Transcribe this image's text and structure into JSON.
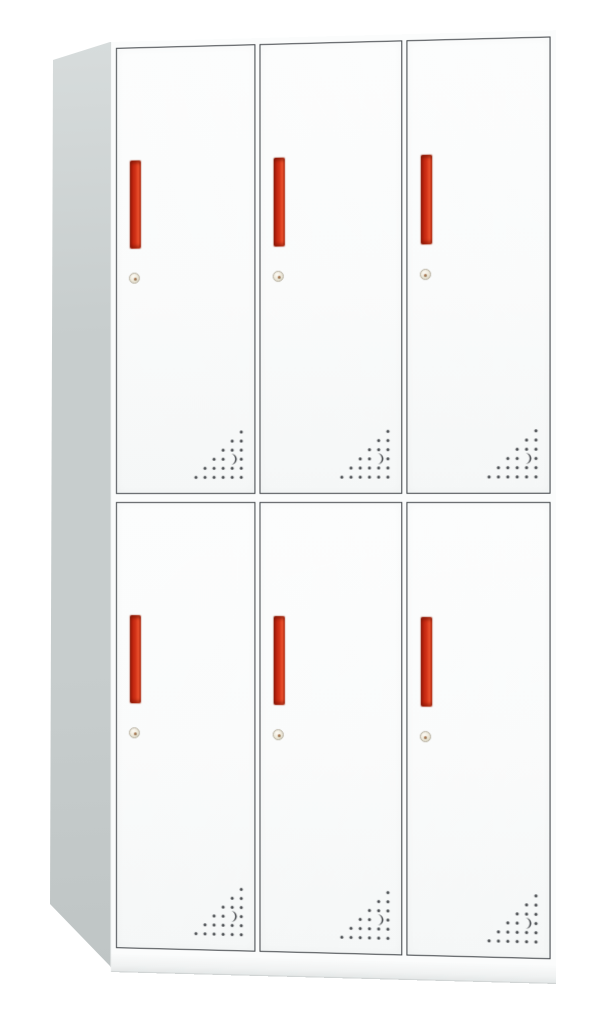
{
  "page": {
    "background_color": "#ffffff",
    "content_type": "product photo, no visible text"
  },
  "cabinet": {
    "name": "six-door metal locker cabinet",
    "description": "Free-standing light grey steel locker with 2 rows x 3 columns of white doors, each door with a vertical red recessed pull handle, a small round key lock below the handle, and a triangular pattern of ventilation holes with a crescent cutout in the lower-right corner",
    "rows": 2,
    "columns": 3,
    "door_count": 6,
    "colors": {
      "page_bg": "#ffffff",
      "side_panel_top": "#d7dcdc",
      "side_panel": "#c7cdcd",
      "side_panel_bottom": "#bfc5c5",
      "front_frame": "#fbfcfc",
      "door_fill": "#fafbfb",
      "door_outline": "#3f4347",
      "handle_red_dark": "#9a1d0b",
      "handle_red": "#d23318",
      "handle_red_bright": "#ee532e",
      "lock_ring": "#b3ac9c",
      "lock_face": "#ece7d8",
      "lock_keyhole": "#8d8166",
      "vent_dot": "#46494d",
      "base_shadow": "#e4e7e7"
    },
    "door_features": {
      "handle": "vertical recessed red pull handle",
      "lock": "round cam lock with keyhole",
      "vent": "right-angled triangular grid of perforation dots with one crescent-shaped cutout"
    },
    "doors": [
      {
        "id": "door-r1-c1",
        "row": 1,
        "col": 1,
        "aria_label": "Locker door, top row left"
      },
      {
        "id": "door-r1-c2",
        "row": 1,
        "col": 2,
        "aria_label": "Locker door, top row center"
      },
      {
        "id": "door-r1-c3",
        "row": 1,
        "col": 3,
        "aria_label": "Locker door, top row right"
      },
      {
        "id": "door-r2-c1",
        "row": 2,
        "col": 1,
        "aria_label": "Locker door, bottom row left"
      },
      {
        "id": "door-r2-c2",
        "row": 2,
        "col": 2,
        "aria_label": "Locker door, bottom row center"
      },
      {
        "id": "door-r2-c3",
        "row": 2,
        "col": 3,
        "aria_label": "Locker door, bottom row right"
      }
    ]
  }
}
